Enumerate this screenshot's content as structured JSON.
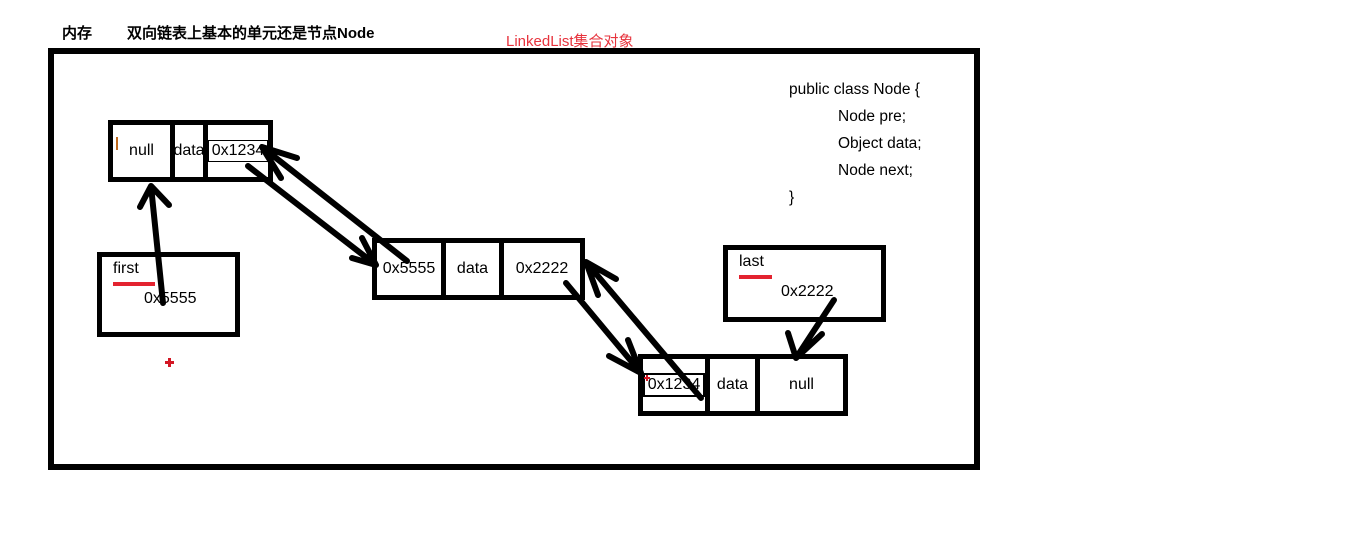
{
  "header": {
    "memory_label": "内存",
    "title": "双向链表上基本的单元还是节点Node",
    "annotation": "LinkedList集合对象"
  },
  "colors": {
    "ink": "#000000",
    "accent_red": "#e32330",
    "annotation_red": "#e7333d"
  },
  "code_snippet": {
    "lines": [
      "public class Node {",
      "Node pre;",
      "Object data;",
      "Node next;",
      "}"
    ]
  },
  "nodes": [
    {
      "pre": "null",
      "data": "data",
      "next": "0x1234"
    },
    {
      "pre": "0x5555",
      "data": "data",
      "next": "0x2222"
    },
    {
      "pre": "0x1234",
      "data": "data",
      "next": "null"
    }
  ],
  "pointers": {
    "first": {
      "label": "first",
      "value": "0x5555"
    },
    "last": {
      "label": "last",
      "value": "0x2222"
    }
  }
}
